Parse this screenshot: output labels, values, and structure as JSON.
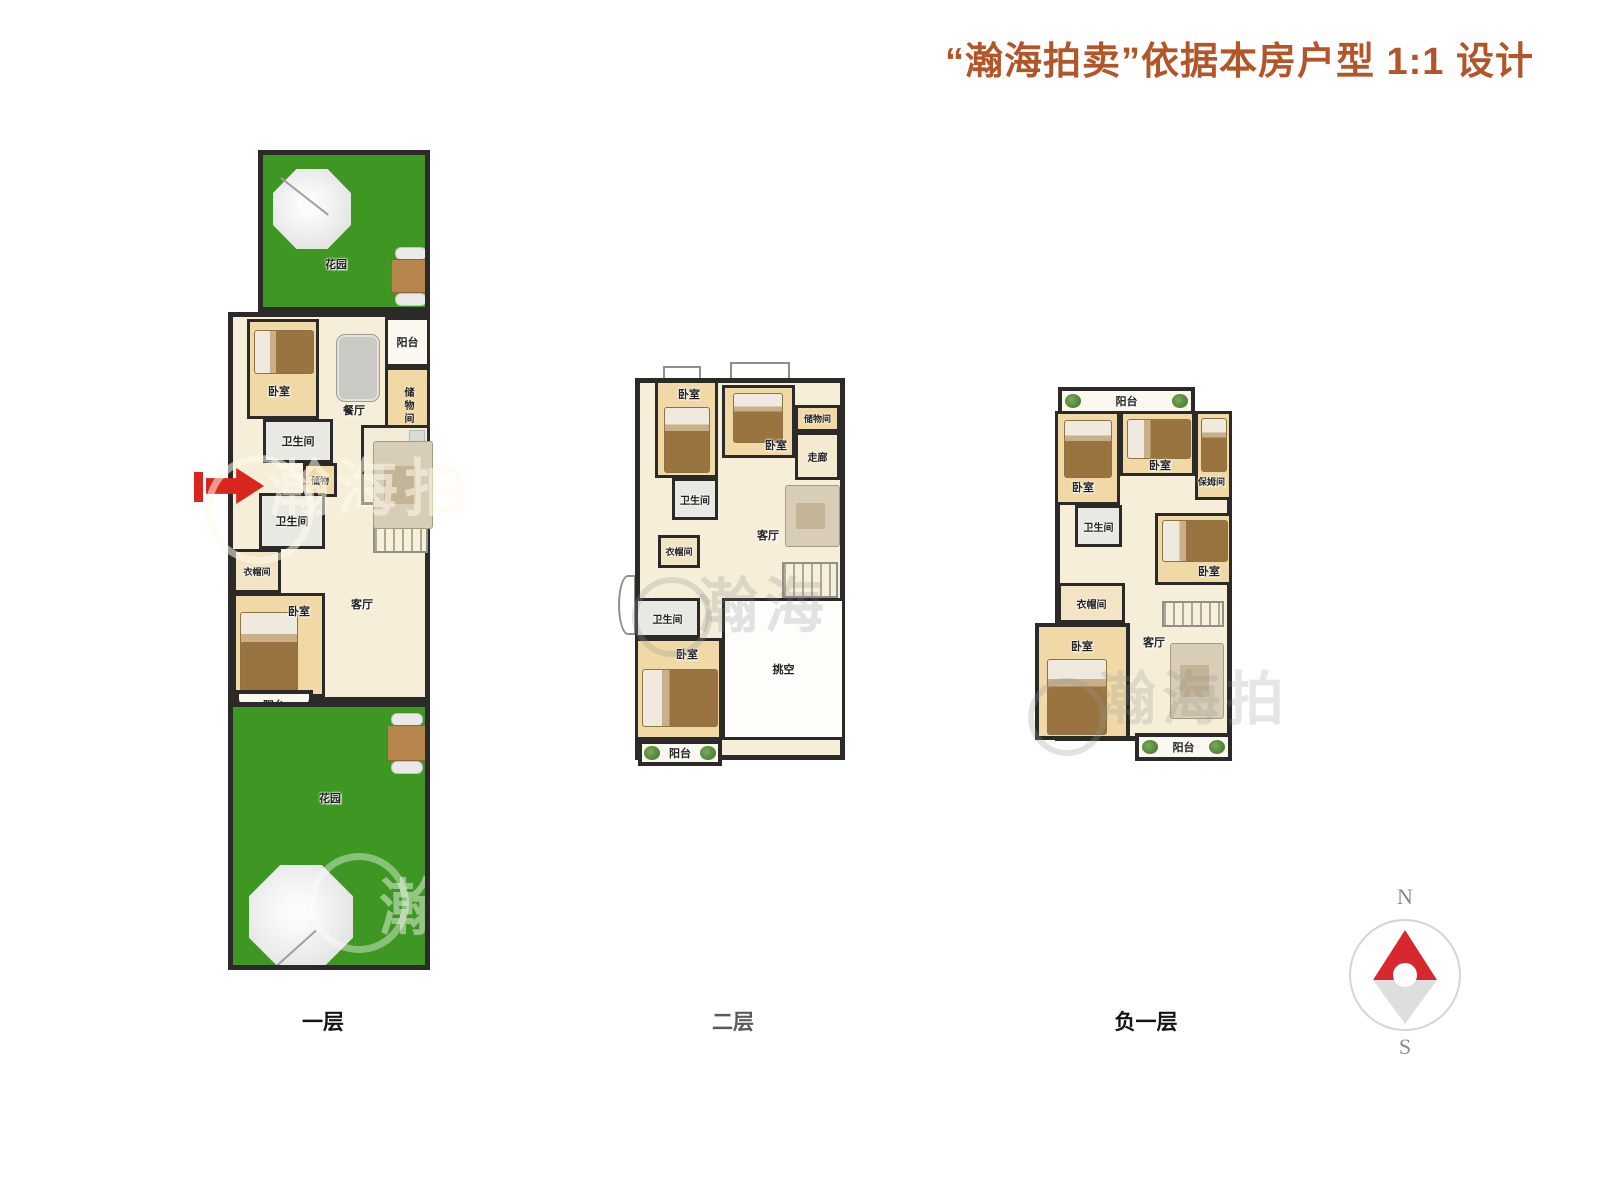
{
  "title": "“瀚海拍卖”依据本房户型 1:1 设计",
  "colors": {
    "title_text": "#b2562a",
    "garden_green": "#3f9723",
    "wall": "#2b2a28",
    "room_tan": "#f0d9a6",
    "hall_cream": "#f6eed8",
    "compass_north_red": "#d7282f",
    "entry_arrow_red": "#d8251d"
  },
  "compass": {
    "north": "N",
    "south": "S"
  },
  "watermarks": [
    "瀚海拍",
    "瀚海",
    "瀚海",
    "瀚海拍"
  ],
  "floors": {
    "f1": {
      "label": "一层",
      "garden_top": "花园",
      "bedroom_a": "卧室",
      "dining": "餐厅",
      "balcony_top": "阳台",
      "storage": "储物间",
      "bath_a": "卫生间",
      "closet": "储物",
      "kitchen": "厨房",
      "bath_b": "卫生间",
      "cloak": "衣帽间",
      "bedroom_b": "卧室",
      "living": "客厅",
      "balcony_bottom": "阳台",
      "garden_bottom": "花园"
    },
    "f2": {
      "label": "二层",
      "bedroom_a": "卧室",
      "bedroom_b": "卧室",
      "storage": "储物间",
      "corridor": "走廊",
      "bath_a": "卫生间",
      "cloak": "衣帽间",
      "bath_b": "卫生间",
      "bedroom_c": "卧室",
      "living": "客厅",
      "void": "挑空",
      "balcony": "阳台"
    },
    "f3": {
      "label": "负一层",
      "balcony_top": "阳台",
      "bedroom_a": "卧室",
      "bedroom_b": "卧室",
      "nanny": "保姆间",
      "bath": "卫生间",
      "bedroom_c": "卧室",
      "cloak": "衣帽间",
      "bedroom_d": "卧室",
      "living": "客厅",
      "balcony_bottom": "阳台"
    }
  }
}
